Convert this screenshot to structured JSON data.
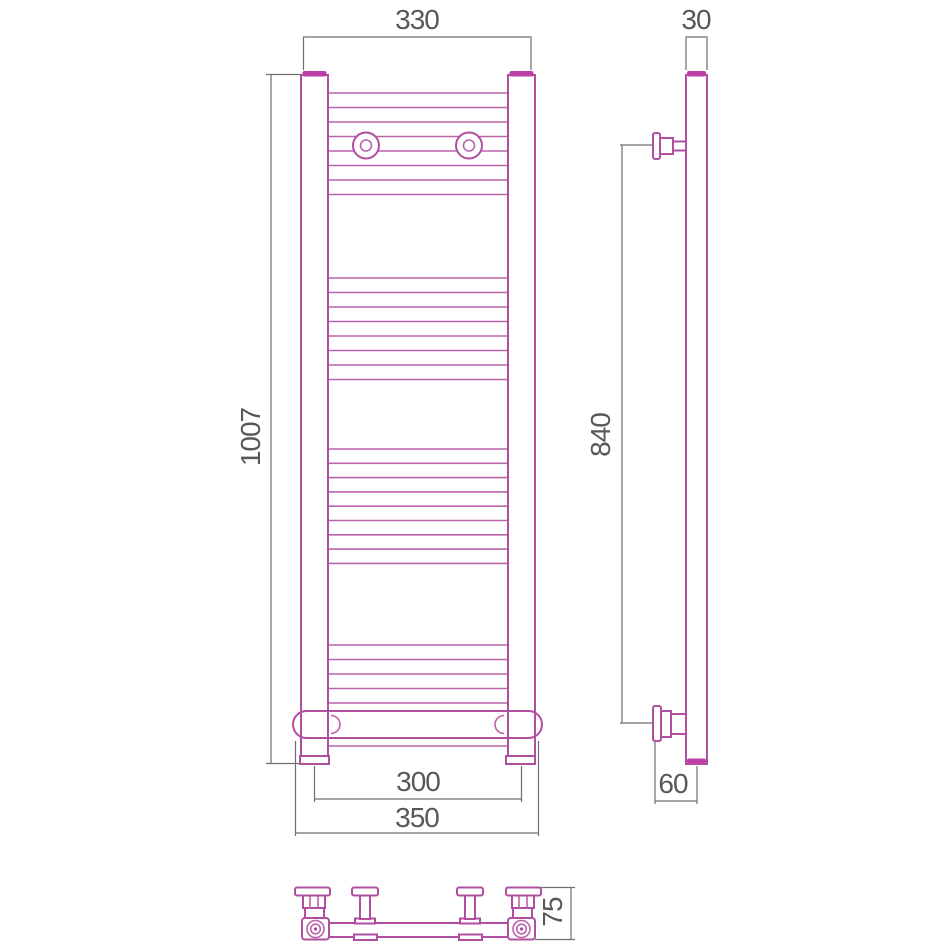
{
  "figure": {
    "description": "Technical drawing, three orthographic views of a ladder towel rail",
    "colors": {
      "outline_magenta": "#b04f9f",
      "dimension_gray": "#6f6f6f",
      "label_gray": "#58585a",
      "background": "#ffffff"
    },
    "views": {
      "front": {
        "dims": {
          "top_width": "330",
          "height": "1007",
          "inner_bottom_width": "300",
          "outer_bottom_width": "350"
        }
      },
      "side": {
        "dims": {
          "depth": "30",
          "mounting_height": "840",
          "bottom_offset": "60"
        }
      },
      "bottom": {
        "dims": {
          "depth": "75"
        }
      }
    }
  }
}
